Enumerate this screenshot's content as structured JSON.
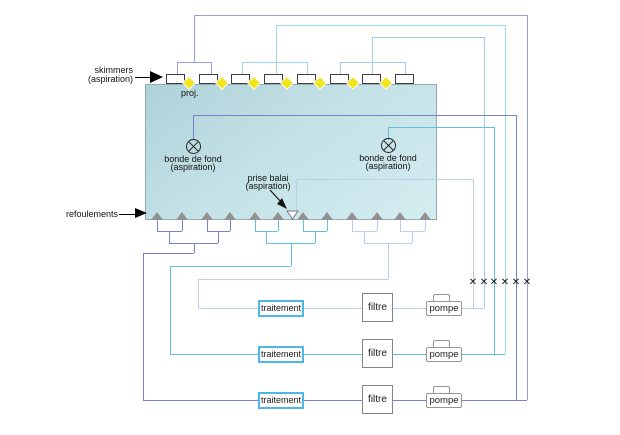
{
  "diagram_title": "pool hydraulic circuit",
  "labels": {
    "skimmers": [
      "skimmers",
      "(aspiration)"
    ],
    "proj": "proj.",
    "bonde_fond_1": [
      "bonde de fond",
      "(aspiration)"
    ],
    "bonde_fond_2": [
      "bonde de fond",
      "(aspiration)"
    ],
    "prise_balai": [
      "prise balai",
      "(aspiration)"
    ],
    "refoulements": "refoulements",
    "valve_symbol": "✕"
  },
  "equipment_rows": [
    {
      "traitement": "traitement",
      "filtre": "filtre",
      "pompe": "pompe"
    },
    {
      "traitement": "traitement",
      "filtre": "filtre",
      "pompe": "pompe"
    },
    {
      "traitement": "traitement",
      "filtre": "filtre",
      "pompe": "pompe"
    }
  ],
  "counts": {
    "skimmers": 8,
    "projectors": 7,
    "refoulement_nozzles": 12,
    "bondes_de_fond": 2,
    "prise_balai": 1,
    "valves": 6,
    "circuits": 3
  },
  "colors": {
    "pool_fill_top": "#aed2d9",
    "pool_fill_bottom": "#d4edf1",
    "projector_yellow": "#f2e51c",
    "nozzle_gray": "#919191",
    "skimmer_group_a_line": "#95a2d8",
    "skimmer_group_b_line": "#9dd8ef",
    "skimmer_group_c_line": "#a9c9e8",
    "circuit1_pale": "#b9cff0",
    "circuit2_cyan": "#5fc2e4",
    "circuit3_slate": "#7583c8",
    "traitement_border": "#4fb6e8"
  }
}
